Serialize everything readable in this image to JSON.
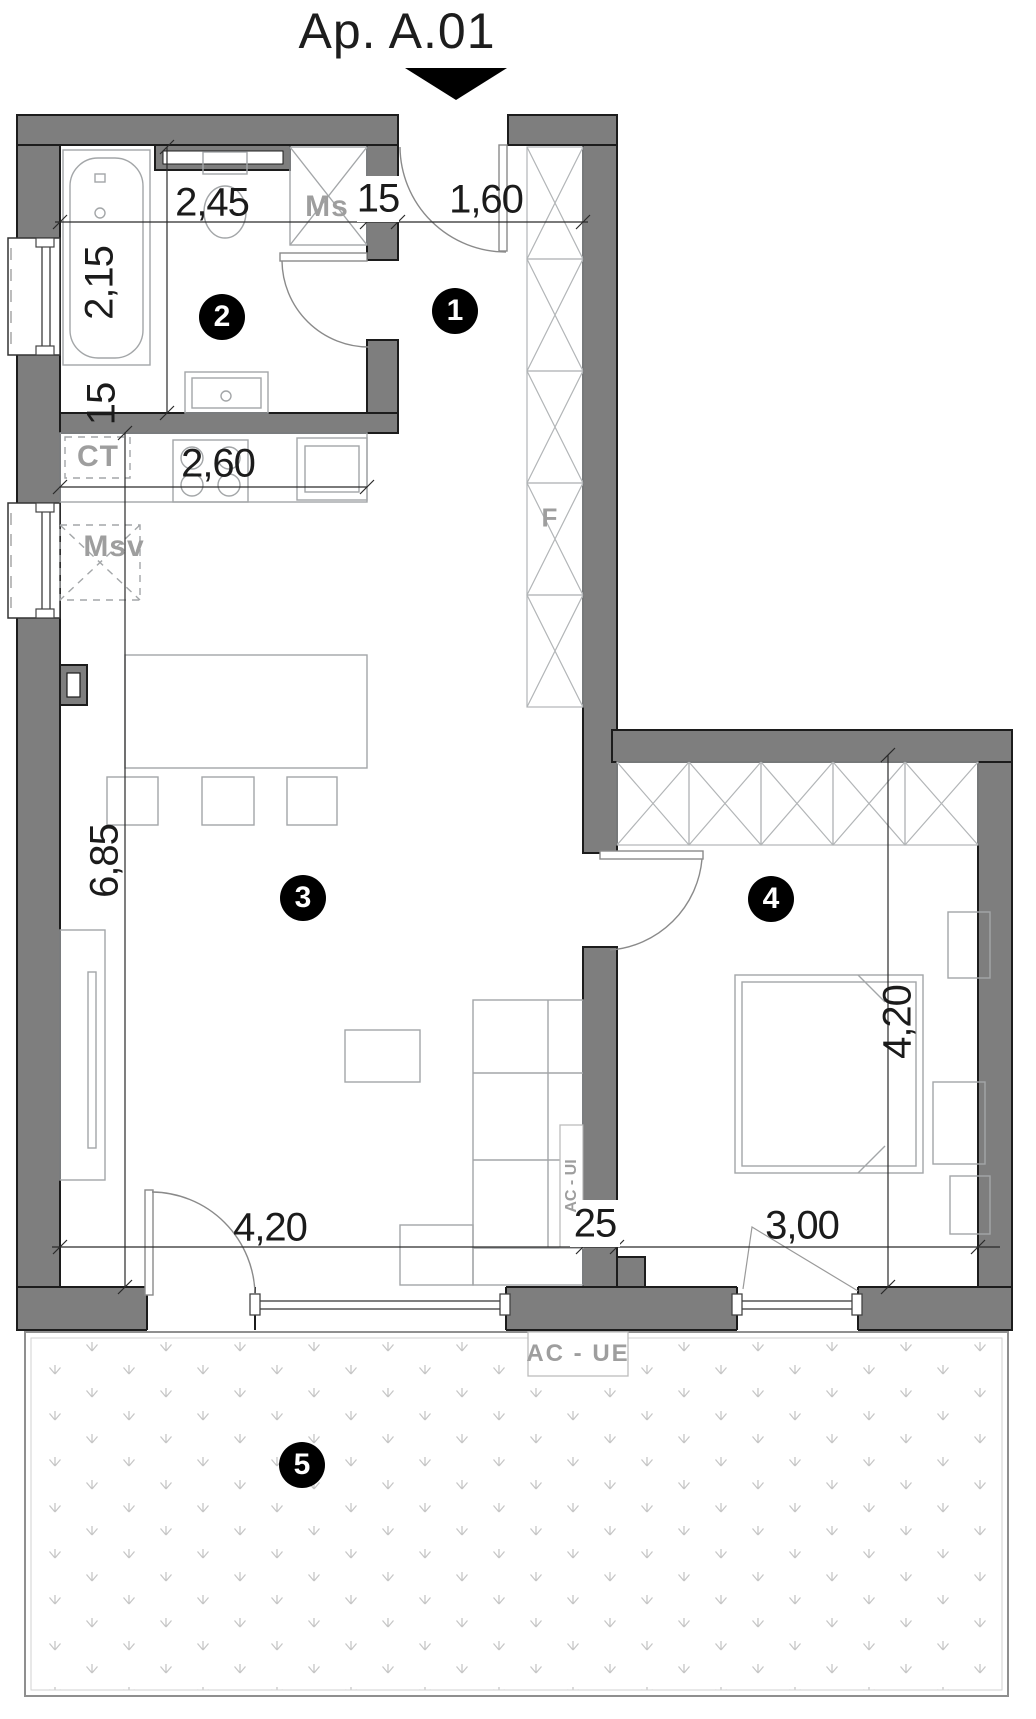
{
  "title": "Ap. A.01",
  "rooms": [
    {
      "number": "1"
    },
    {
      "number": "2"
    },
    {
      "number": "3"
    },
    {
      "number": "4"
    },
    {
      "number": "5"
    }
  ],
  "labels": {
    "washing_machine": "Ms",
    "boiler": "CT",
    "dishwasher": "Msv",
    "shaft": "F",
    "ac_indoor_unit": "AC - UI",
    "ac_outdoor_unit": "AC - UE"
  },
  "dimensions": {
    "bathroom_width": "2,45",
    "bathroom_wall_thickness": "15",
    "hallway_width": "1,60",
    "bathroom_length": "2,15",
    "kitchen_wall_thickness": "15",
    "kitchen_width": "2,60",
    "living_length": "6,85",
    "living_width": "4,20",
    "partition_wall_thickness": "25",
    "bedroom_width": "3,00",
    "bedroom_length": "4,20"
  },
  "colors": {
    "wall_fill": "#7e7e7e",
    "outline": "#1c1c1c",
    "furniture_line": "#a3a6a8",
    "label_gray": "#9e9e9e",
    "badge": "#000000"
  }
}
